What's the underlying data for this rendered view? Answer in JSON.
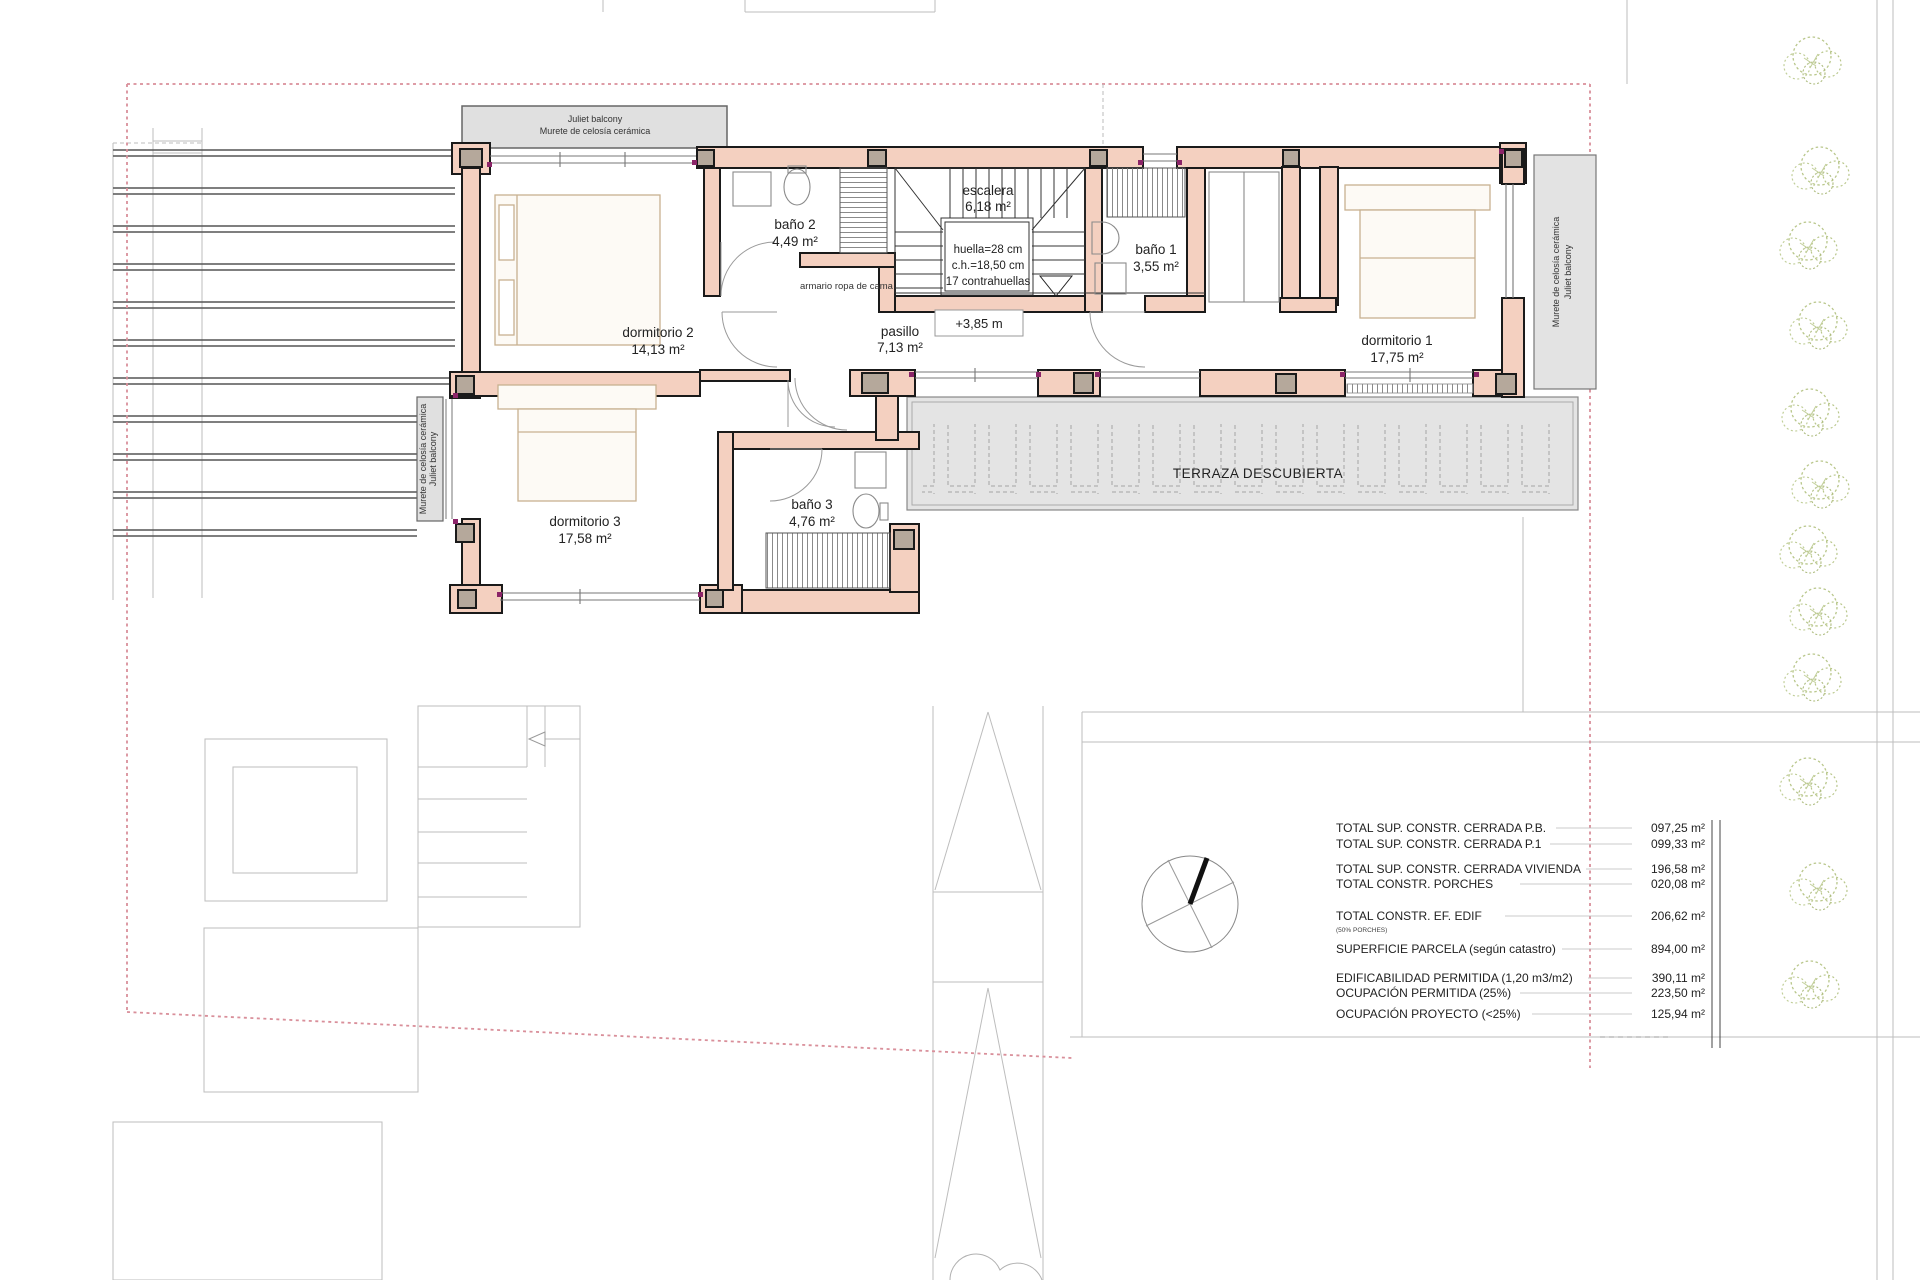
{
  "plan": {
    "balcony_top": {
      "line1": "Juliet balcony",
      "line2": "Murete de celosía cerámica"
    },
    "balcony_left": {
      "line1": "Murete de celosía cerámica",
      "line2": "Juliet balcony"
    },
    "muro_right": {
      "line1": "Murete de celosía cerámica",
      "line2": "Juliet balcony"
    },
    "rooms": [
      {
        "name": "dormitorio 2",
        "area": "14,13 m²"
      },
      {
        "name": "baño 2",
        "area": "4,49 m²"
      },
      {
        "name": "escalera",
        "area": "6,18 m²"
      },
      {
        "name": "baño 1",
        "area": "3,55 m²"
      },
      {
        "name": "dormitorio 1",
        "area": "17,75 m²"
      },
      {
        "name": "pasillo",
        "area": "7,13 m²"
      },
      {
        "name": "dormitorio 3",
        "area": "17,58 m²"
      },
      {
        "name": "baño 3",
        "area": "4,76 m²"
      }
    ],
    "stair_note": {
      "line1": "huella=28 cm",
      "line2": "c.h.=18,50 cm",
      "line3": "17 contrahuellas"
    },
    "closet_label": "armario ropa de cama",
    "level_marker": "+3,85 m",
    "terrace_label": "TERRAZA DESCUBIERTA"
  },
  "summary": {
    "rows": [
      {
        "label": "TOTAL SUP. CONSTR. CERRADA P.B.",
        "value": "097,25 m²"
      },
      {
        "label": "TOTAL SUP. CONSTR. CERRADA P.1",
        "value": "099,33 m²"
      },
      {
        "label": "TOTAL SUP. CONSTR. CERRADA VIVIENDA",
        "value": "196,58 m²"
      },
      {
        "label": "TOTAL  CONSTR. PORCHES",
        "value": "020,08 m²"
      },
      {
        "label": "TOTAL  CONSTR.  EF. EDIF",
        "note": "(50% PORCHES)",
        "value": "206,62 m²"
      },
      {
        "label": "SUPERFICIE PARCELA (según catastro)",
        "value": "894,00 m²"
      },
      {
        "label": "EDIFICABILIDAD PERMITIDA (1,20 m3/m2)",
        "value": "390,11 m²"
      },
      {
        "label": "OCUPACIÓN PERMITIDA (25%)",
        "value": "223,50 m²"
      },
      {
        "label": "OCUPACIÓN PROYECTO (<25%)",
        "value": "125,94 m²"
      }
    ]
  },
  "colors": {
    "wall_fill": "#f4d0c0",
    "wall_stroke": "#1a1a1a",
    "column_fill": "#b5a89b",
    "gray_area": "#e4e4e4",
    "parcel_boundary": "#d98f9a",
    "corner_dot": "#8b2468",
    "furniture": "#c8b190",
    "background_line": "#bdbdbd",
    "tree": "#b9c78b"
  }
}
